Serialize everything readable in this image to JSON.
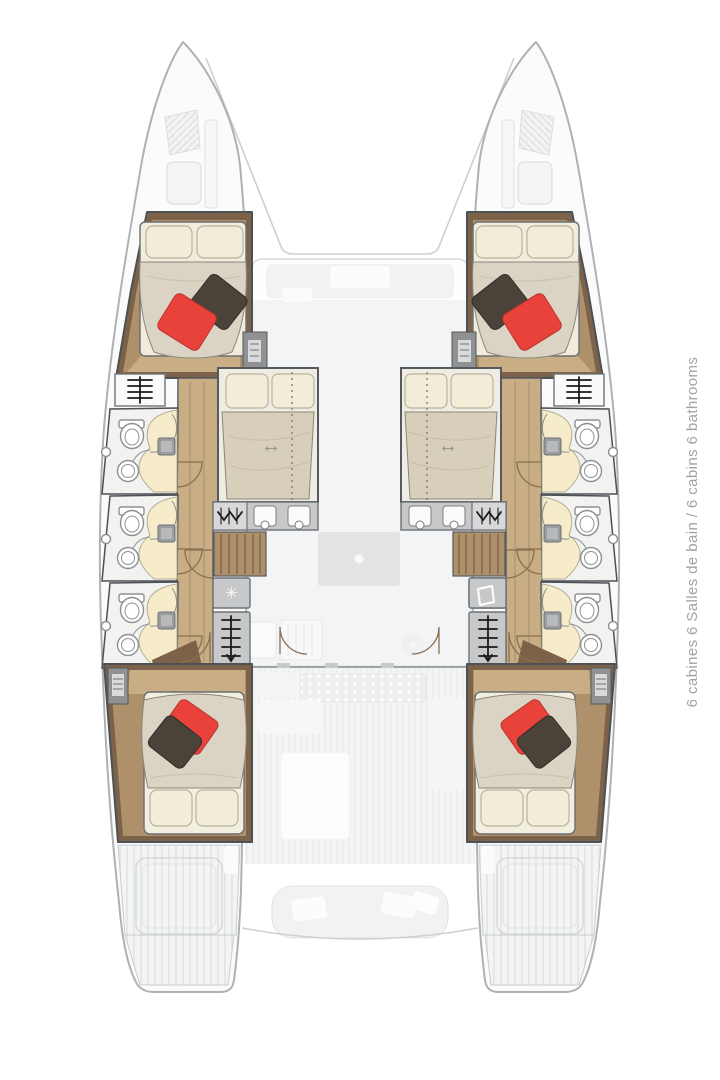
{
  "caption": {
    "text": "6 cabines 6 Salles de bain / 6 cabins 6 bathrooms"
  },
  "icons": {
    "snowflake": "✳",
    "double_arrow": "↔"
  },
  "palette": {
    "hull": "#fbfbfc",
    "hullLine": "#aeb2b5",
    "wall": "#4c5156",
    "woodDark": "#7b6249",
    "wood": "#ae906b",
    "woodLight": "#c9ae85",
    "woodLine": "#8d7354",
    "duvet": "#dbd3c3",
    "duvetLine": "#8b877c",
    "pillow": "#f2edd8",
    "pillowLine": "#b9b39a",
    "red": "#e8423a",
    "redLine": "#b8352e",
    "dark": "#4b423a",
    "darkLine": "#332d27",
    "bathFloor": "#f2f2f1",
    "shower": "#f6ecca",
    "showerLine": "#b4ad94",
    "fixture": "#ffffff",
    "fixtureLine": "#8d9093",
    "panel": "#c6c8c9",
    "panelLight": "#d6d8d9",
    "panelLine": "#6f7275",
    "glyph": "#1a1a1a",
    "doorArc": "#8a6f52",
    "faintA": "#f3f4f5",
    "faintB": "#e4e5e6",
    "caption": "#a3a3a3"
  }
}
